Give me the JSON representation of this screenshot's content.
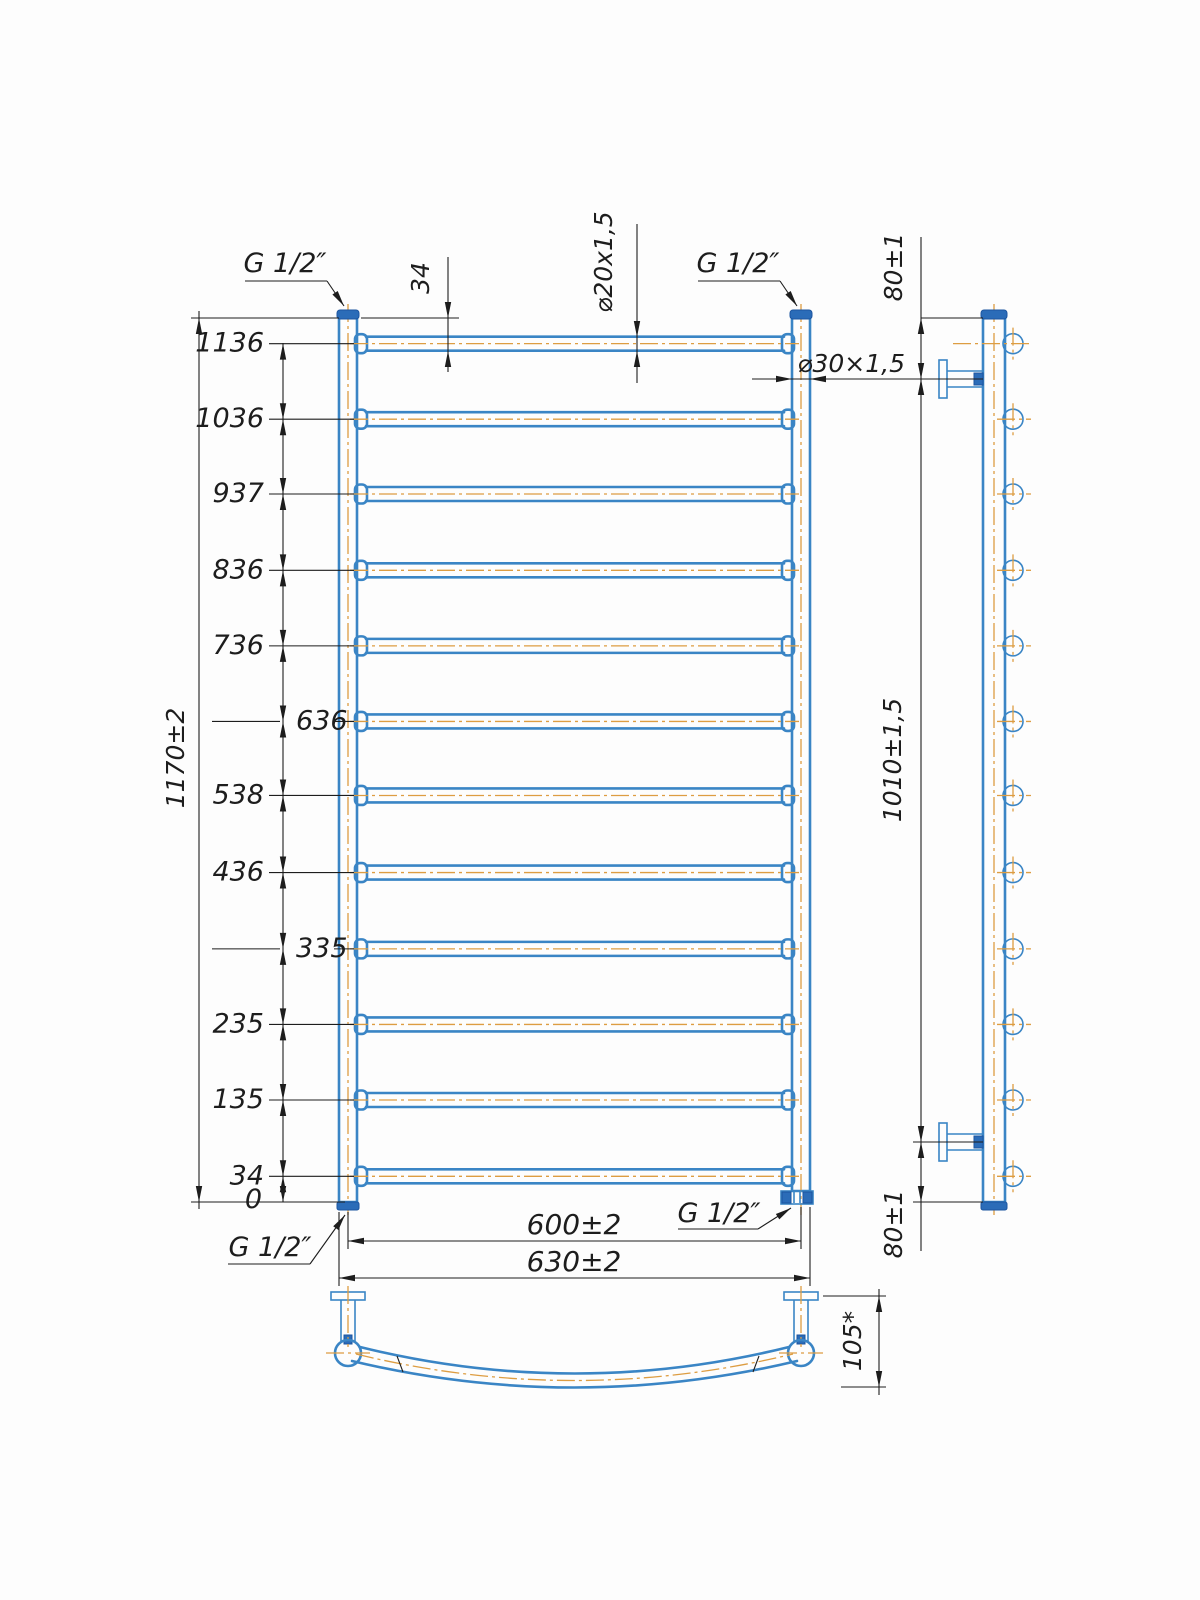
{
  "drawing": {
    "front_view": {
      "overall_height": "1170±2",
      "rung_heights": [
        1136,
        1036,
        937,
        836,
        736,
        636,
        538,
        436,
        335,
        235,
        135,
        34
      ],
      "datum": "0",
      "top_rung_offset": "34",
      "rung_tube": "⌀20x1,5",
      "post_tube": "⌀30×1,5",
      "axis_width": "600±2",
      "overall_width": "630±2",
      "threads": {
        "top_left": "G 1/2″",
        "top_right": "G 1/2″",
        "bottom_left": "G 1/2″",
        "bottom_right": "G 1/2″"
      }
    },
    "side_view": {
      "top_bracket_offset": "80±1",
      "bracket_span": "1010±1,5",
      "bottom_bracket_offset": "80±1"
    },
    "bottom_view": {
      "depth": "105*"
    },
    "colors": {
      "outline": "#3a85c5",
      "fitting_fill": "#2b6cb8",
      "centerline": "#dd9d42",
      "dimension": "#1d1d1d"
    }
  }
}
